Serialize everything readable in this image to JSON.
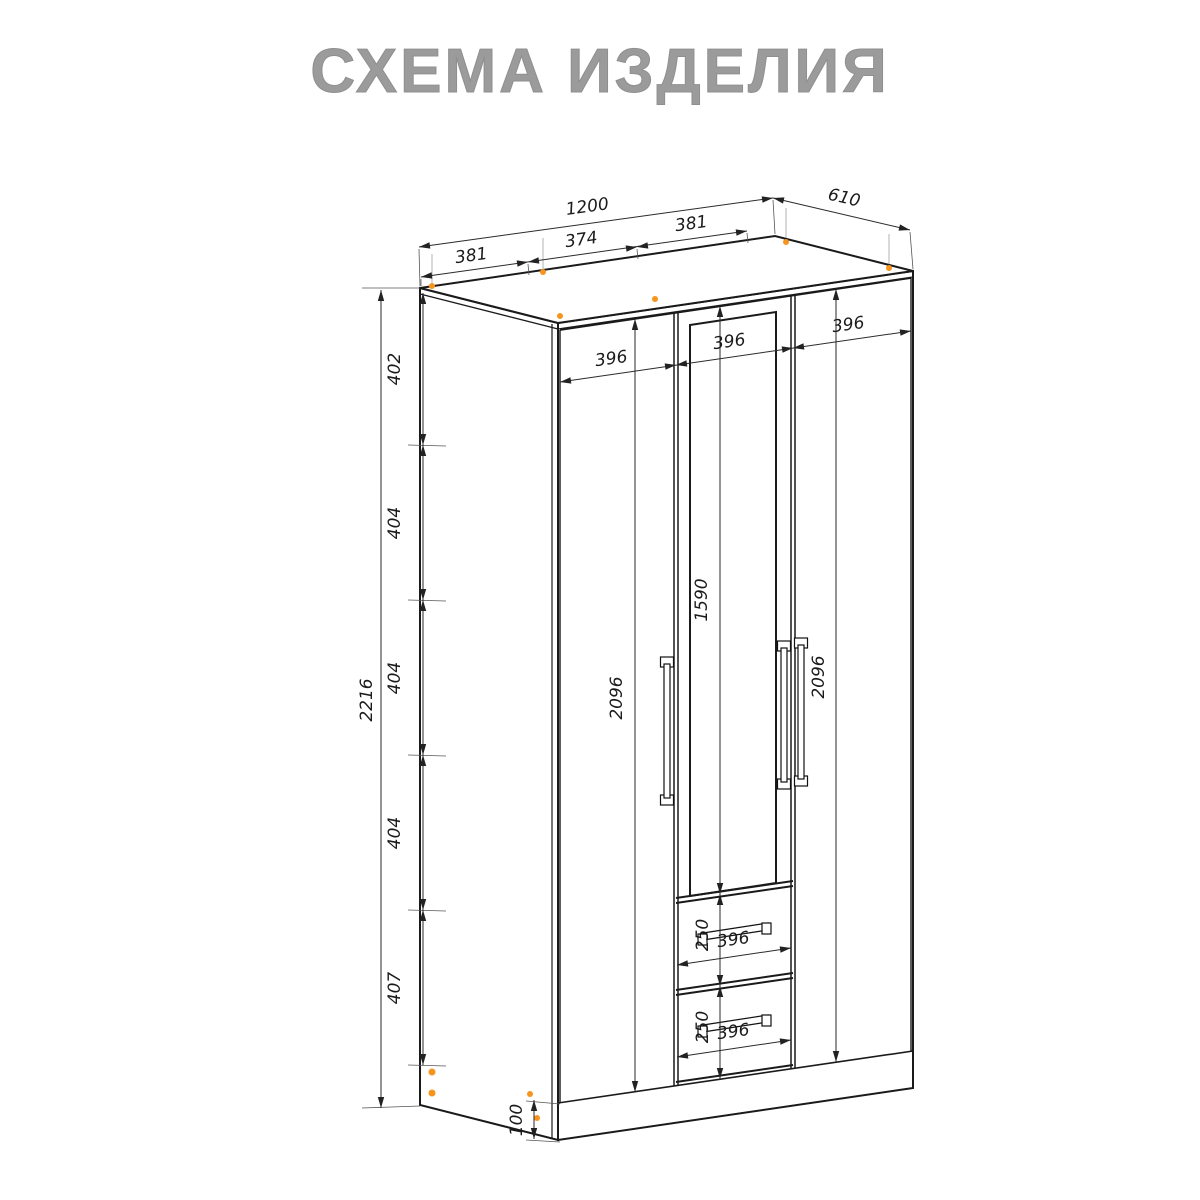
{
  "title": "СХЕМА ИЗДЕЛИЯ",
  "colors": {
    "outline": "#1a1a1a",
    "ghost": "#c9c9c9",
    "dimension_text": "#1b1b1b",
    "fastener_orange": "#f7941d",
    "title_gray": "#9b9b9b"
  },
  "dims": {
    "width_total": "1200",
    "depth": "610",
    "top_sections": [
      "381",
      "374",
      "381"
    ],
    "height_total": "2216",
    "left_segments": [
      "402",
      "404",
      "404",
      "404",
      "407"
    ],
    "base_height": "100",
    "door_widths": [
      "396",
      "396",
      "396"
    ],
    "door_height_left": "2096",
    "door_height_right": "2096",
    "mirror_height": "1590",
    "drawers": [
      {
        "height": "250",
        "width": "396"
      },
      {
        "height": "250",
        "width": "396"
      }
    ]
  }
}
